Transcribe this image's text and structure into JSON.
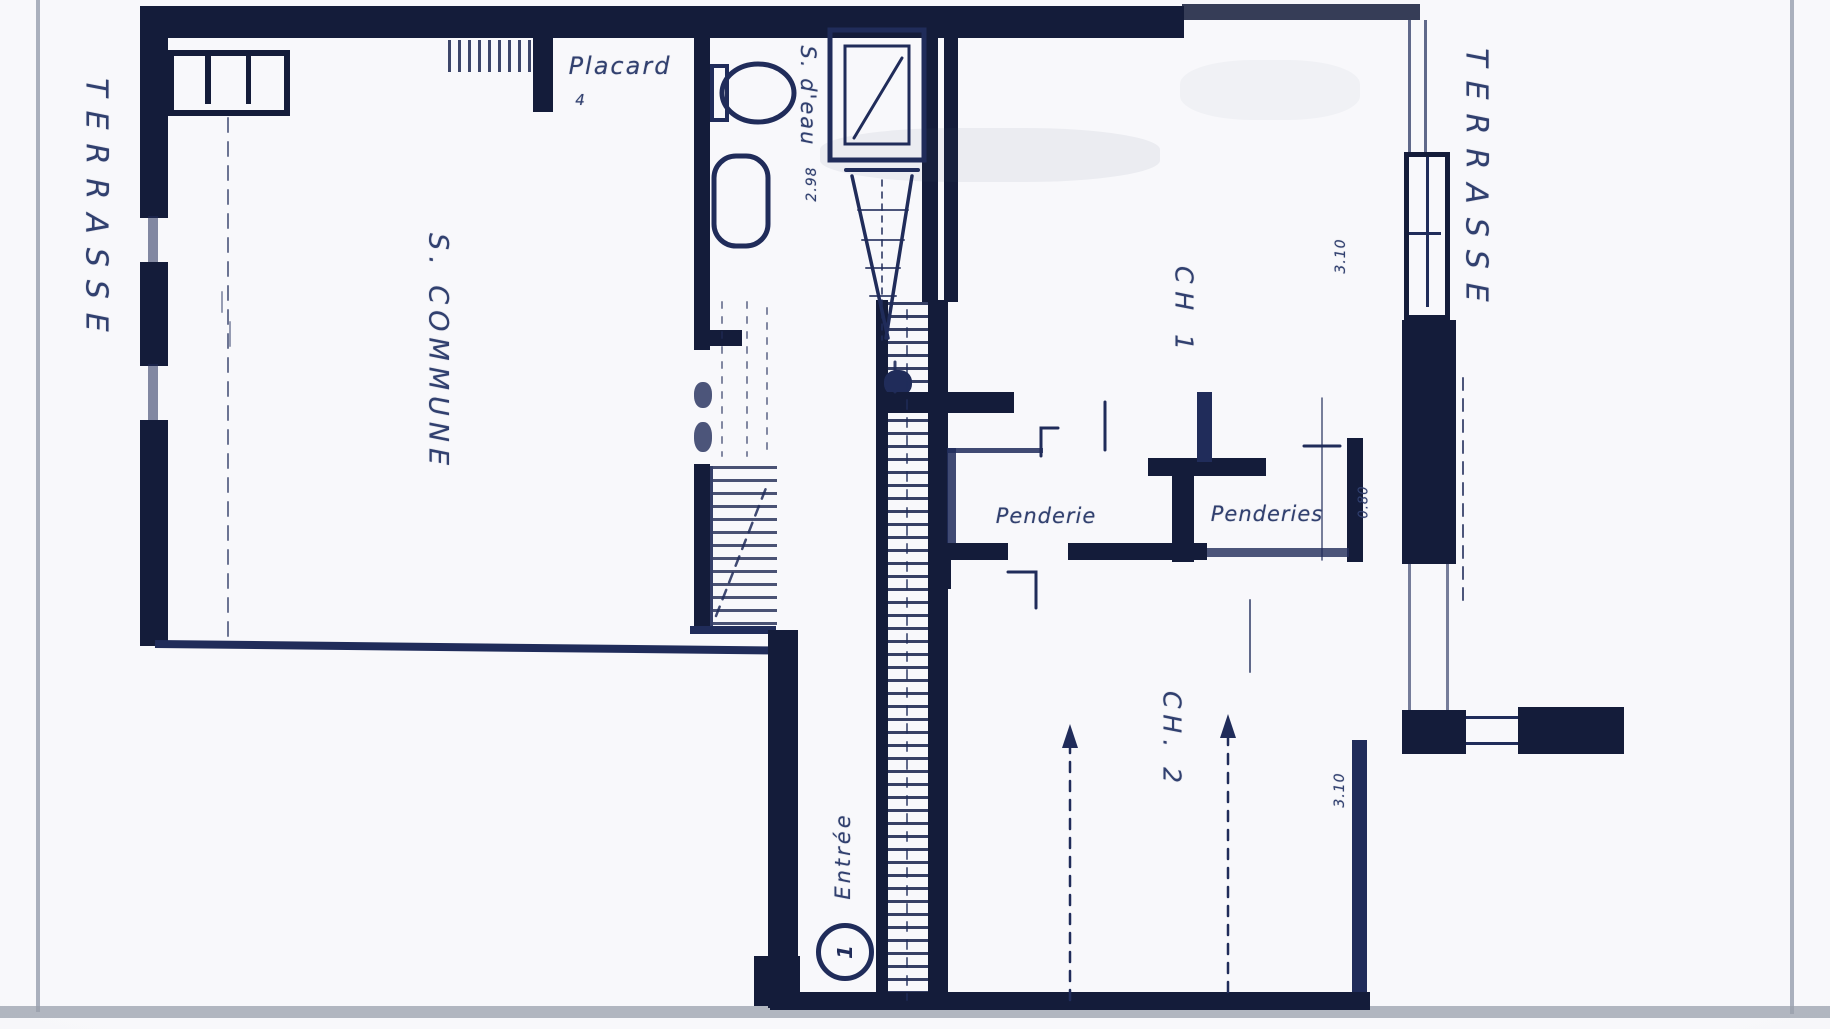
{
  "colors": {
    "page": "#f8f8fb",
    "ink": "#202c5a",
    "ink-soft": "#31406f",
    "wall": "#141c3a",
    "scan-gray": "#9aa0ac",
    "border-gray": "#aab0bd"
  },
  "labels": {
    "terrasse_left": "TERRASSE",
    "terrasse_right": "TERRASSE",
    "s_commune": "S. COMMUNE",
    "placard": "Placard",
    "s_deau": "S. d'eau",
    "ch1": "CH 1",
    "ch2": "CH. 2",
    "penderie": "Penderie",
    "penderies": "Penderies",
    "entree": "Entrée"
  },
  "dimensions": {
    "s_deau_depth": "2.98",
    "ch1_width": "3.10",
    "ch2_width": "3.10",
    "penderies_door": "0.80",
    "placard_note": "4"
  },
  "symbols": {
    "entry_door_number": "1",
    "fixtures": [
      "wc",
      "washbasin",
      "shower",
      "staircase",
      "windows"
    ]
  }
}
